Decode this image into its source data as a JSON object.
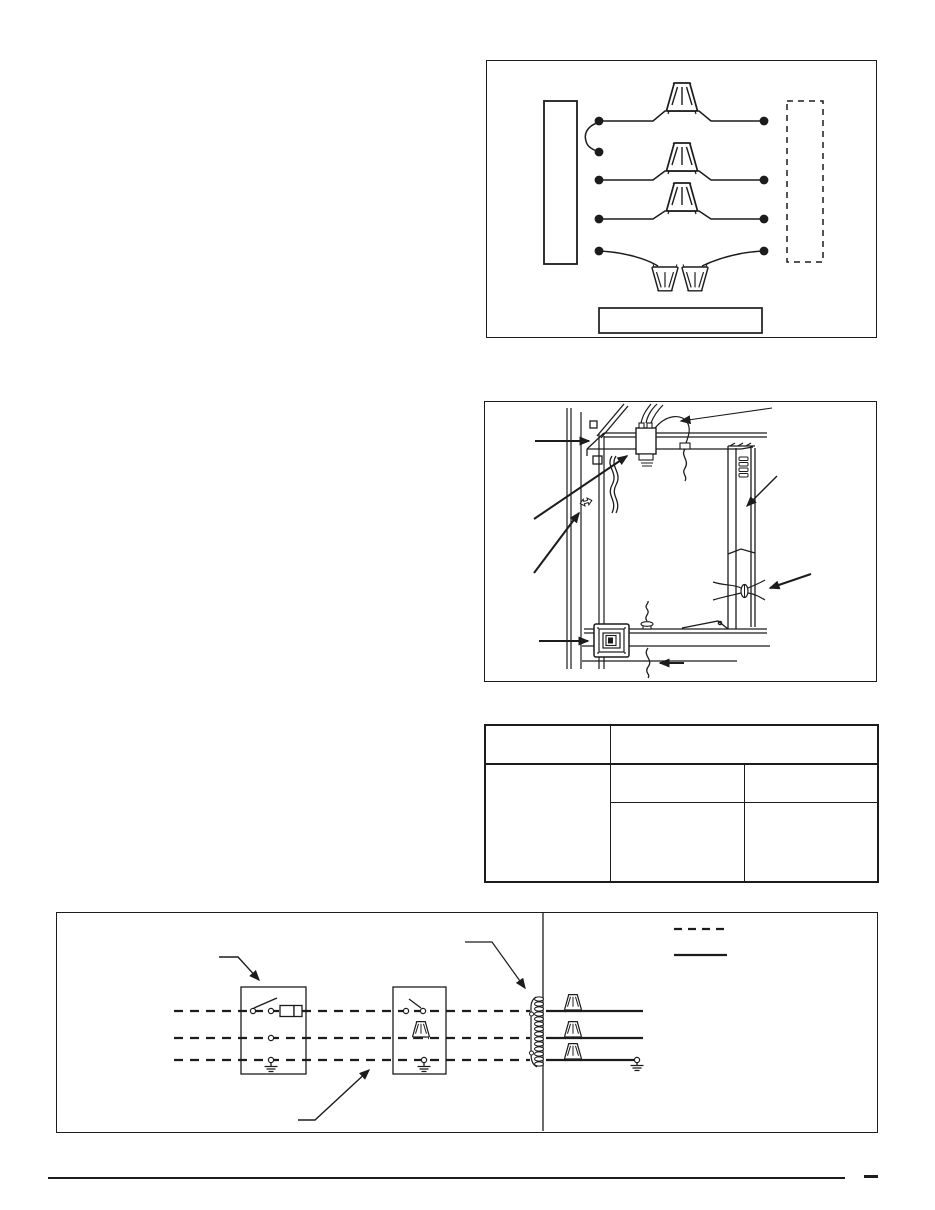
{
  "page": {
    "background": "#ffffff",
    "ink_color": "#1c1c1c"
  },
  "figure_wire_hookup": {
    "kind": "wiring-hookup-diagram",
    "wire_rows": 4,
    "upright_wire_nuts": 3,
    "inverted_wire_nuts": 2,
    "connection_dots_left": 5,
    "connection_dots_right": 4,
    "solid_panel_box": true,
    "dashed_panel_box": true,
    "label_plate_box": true
  },
  "figure_installation": {
    "kind": "frame-installation-illustration",
    "callout_arrows": 8,
    "junction_box": true,
    "wall_switch": true,
    "wire_grommet": true,
    "hanging_wires": 4
  },
  "spec_table": {
    "rows": 3,
    "columns": 3,
    "header_row_span_right": 2,
    "left_column_rowspan": 2
  },
  "figure_schematic": {
    "kind": "wiring-schematic",
    "circuit_lines": 3,
    "component_boxes": 2,
    "wire_nuts": 4,
    "ground_symbols": 3,
    "terminal_coil": true,
    "legend": {
      "dashed_line_sample": true,
      "solid_line_sample": true
    },
    "callout_arrows": 3
  },
  "footer": {
    "horizontal_rule": true,
    "page_number_dash": true
  }
}
